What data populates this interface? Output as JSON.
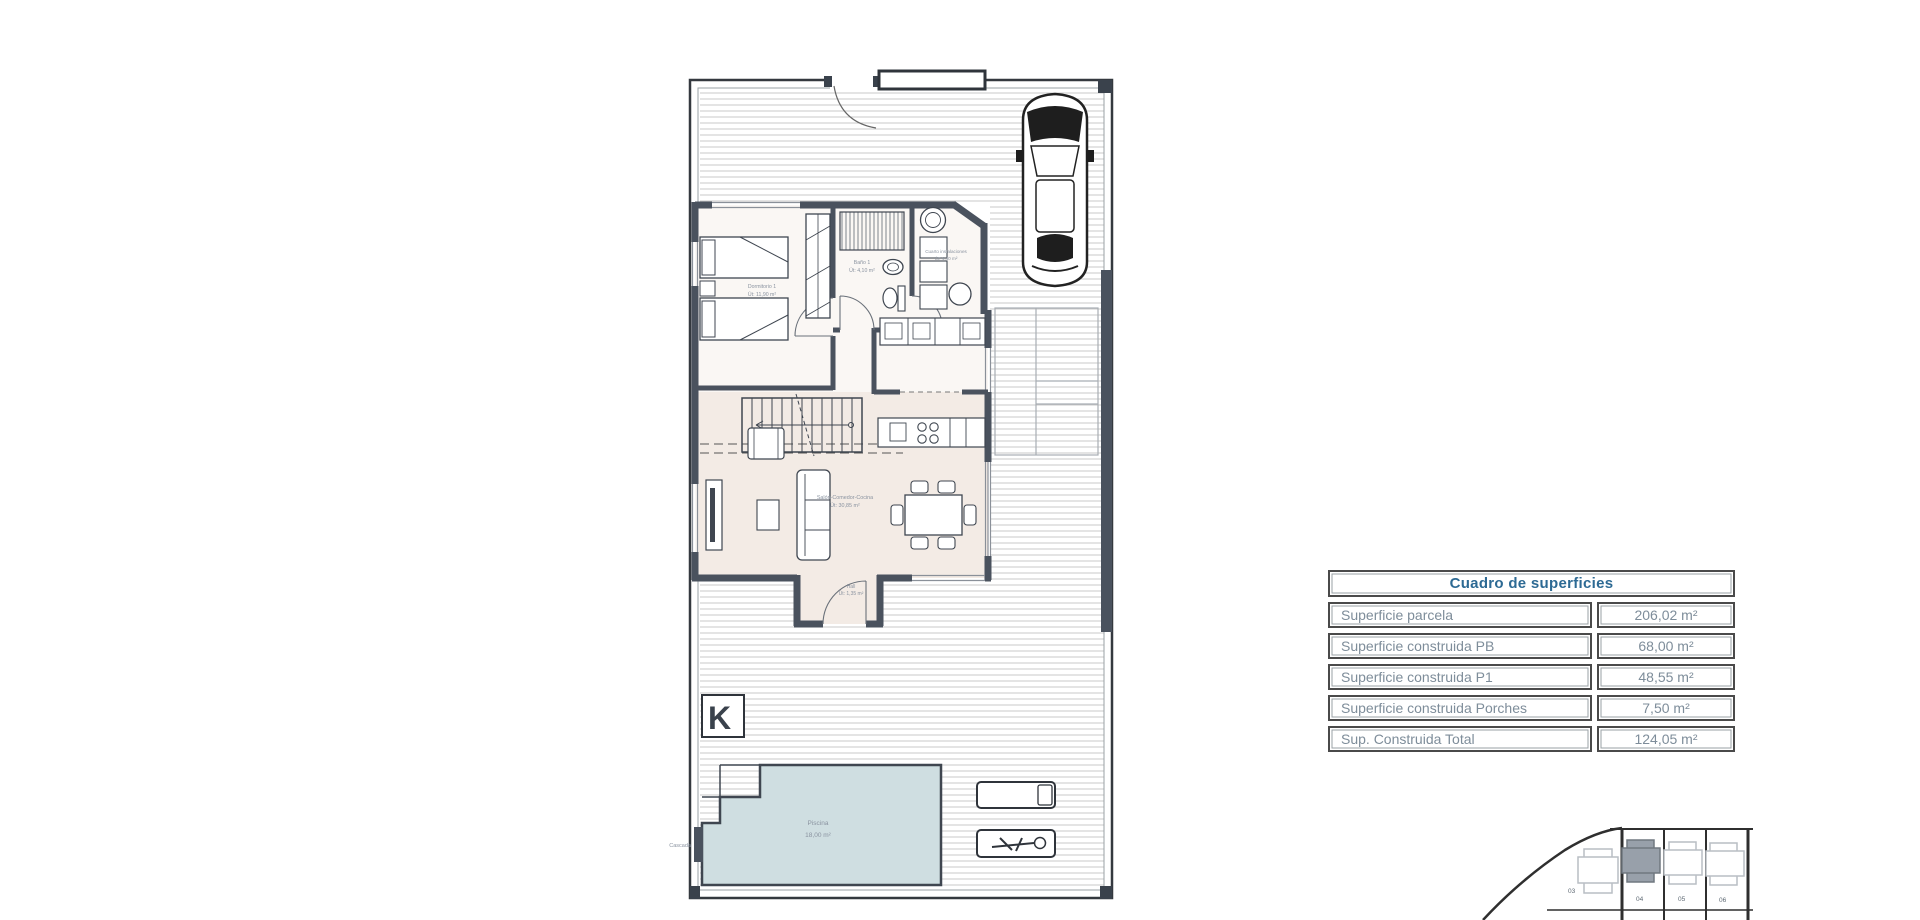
{
  "floor_plan": {
    "labels": {
      "bedroom_name": "Dormitorio 1",
      "bedroom_area": "Út: 11,90 m²",
      "bath_name": "Baño 1",
      "bath_area": "Út: 4,10 m²",
      "utility_name": "Cuarto instalaciones",
      "utility_area": "Út: 4,40 m²",
      "living_name": "Salón-Comedor-Cocina",
      "living_area": "Út: 30,85 m²",
      "hall_name": "Hall",
      "hall_area": "Út: 1,35 m²",
      "pool_name": "Piscina",
      "pool_area": "18,00 m²",
      "cascade": "Cascada",
      "logo_letter": "K"
    }
  },
  "surfaces_table": {
    "title": "Cuadro de superficies",
    "rows": [
      {
        "label": "Superficie parcela",
        "value": "206,02 m²"
      },
      {
        "label": "Superficie construida PB",
        "value": "68,00 m²"
      },
      {
        "label": "Superficie construida P1",
        "value": "48,55 m²"
      },
      {
        "label": "Superficie construida Porches",
        "value": "7,50 m²"
      },
      {
        "label": "Sup. Construida Total",
        "value": "124,05 m²"
      }
    ]
  },
  "site_map": {
    "plots": [
      {
        "id": "03",
        "highlighted": false
      },
      {
        "id": "04",
        "highlighted": true
      },
      {
        "id": "05",
        "highlighted": false
      },
      {
        "id": "06",
        "highlighted": false
      }
    ]
  },
  "colors": {
    "wall": "#4a525e",
    "hatch": "#c6c6c6",
    "pool_fill": "#cfdee1",
    "living_floor": "#f3ebe5",
    "table_title": "#2d6a94",
    "table_text": "#7e8d9a",
    "highlight_plot": "#98a0aa"
  }
}
